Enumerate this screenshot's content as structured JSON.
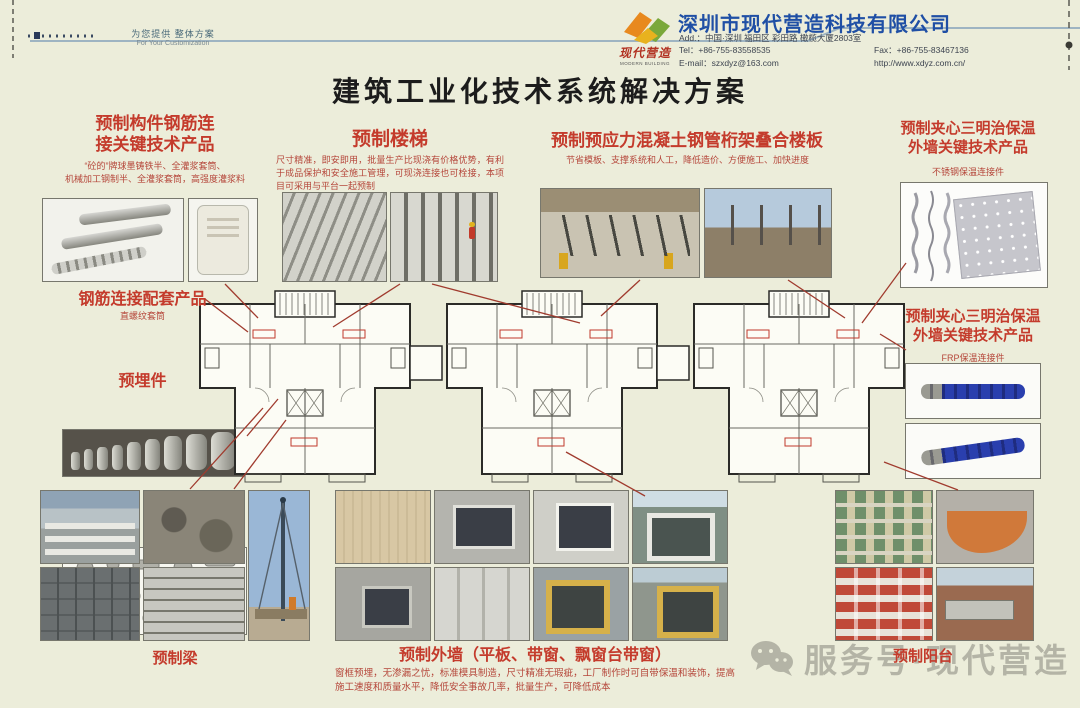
{
  "page": {
    "tagline_cn": "为您提供 整体方案",
    "tagline_en": "For Your Customization",
    "title": "建筑工业化技术系统解决方案",
    "watermark": "服务号·现代营造"
  },
  "company": {
    "name": "深圳市现代营造科技有限公司",
    "logo_text": "现代营造",
    "logo_sub": "MODERN BUILDING",
    "address": "Add.：中国·深圳 福田区 彩田路 橄榄大厦2803室",
    "tel": "Tel：+86-755-83558535",
    "fax": "Fax：+86-755-83467136",
    "email": "E-mail：szxdyz@163.com",
    "web": "http://www.xdyz.com.cn/"
  },
  "sections": {
    "rebar": {
      "title1": "预制构件钢筋连",
      "title2": "接关键技术产品",
      "desc1": "“砼的”牌球墨铸铁半、全灌浆套筒、",
      "desc2": "机械加工钢制半、全灌浆套筒，高强度灌浆料"
    },
    "stairs": {
      "title": "预制楼梯",
      "desc": "尺寸精准，即安即用，批量生产比现浇有价格优势，有利于成品保护和安全施工管理，可现浇连接也可栓接，本项目可采用与平台一起预制"
    },
    "slab": {
      "title": "预制预应力混凝土钢管桁架叠合楼板",
      "desc": "节省模板、支撑系统和人工，降低造价、方便施工、加快进度"
    },
    "sandwich_steel": {
      "title1": "预制夹心三明治保温",
      "title2": "外墙关键技术产品",
      "sub": "不锈钢保温连接件"
    },
    "coupler": {
      "title": "钢筋连接配套产品",
      "sub": "直螺纹套筒"
    },
    "embedded": {
      "title": "预埋件"
    },
    "sandwich_frp": {
      "title1": "预制夹心三明治保温",
      "title2": "外墙关键技术产品",
      "sub": "FRP保温连接件"
    },
    "beam": {
      "title": "预制梁"
    },
    "wall": {
      "title": "预制外墙（平板、带窗、飘窗台带窗）",
      "desc": "窗框预埋，无渗漏之忧，标准模具制造，尺寸精准无瑕疵，工厂制作时可自带保温和装饰，提高施工速度和质量水平，降低安全事故几率，批量生产，可降低成本"
    },
    "balcony": {
      "title": "预制阳台"
    }
  },
  "colors": {
    "background": "#ecedda",
    "accent_red": "#c43b2c",
    "company_blue": "#1f4fa5",
    "connector_line": "#a03b2e",
    "watermark_gray": "#8f8f84"
  }
}
